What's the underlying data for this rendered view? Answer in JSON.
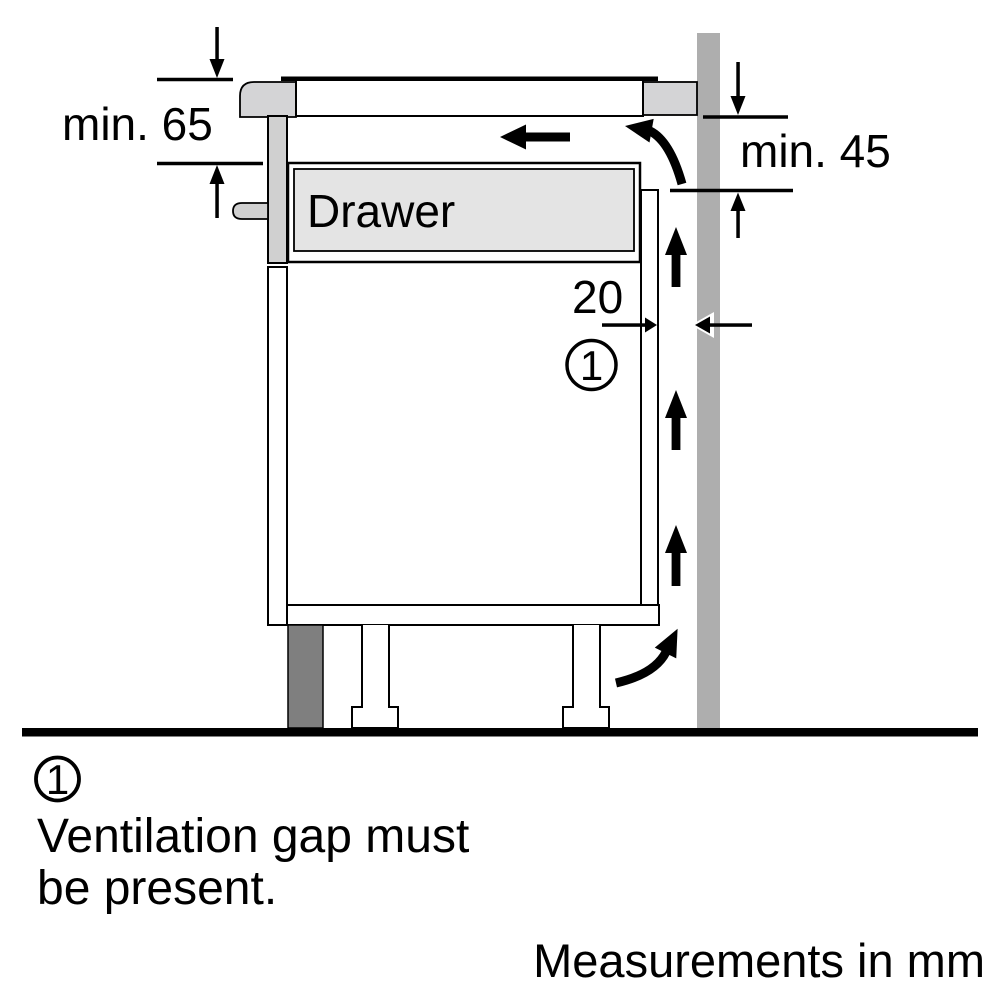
{
  "diagram": {
    "dimensions": {
      "top_left": "min. 65",
      "top_right": "min. 45",
      "ventilation_gap": "20"
    },
    "drawer_label": "Drawer",
    "callout_marker": "1",
    "colors": {
      "wall": "#aeaeae",
      "plinth": "#7f7f7f",
      "drawer": "#e4e4e4",
      "hob_trim": "#d4d4d6",
      "panel": "#d0d0d0",
      "outline": "#000000",
      "background": "#ffffff"
    }
  },
  "legend": {
    "marker": "1",
    "text_line1": "Ventilation gap must",
    "text_line2": "be present."
  },
  "footer": {
    "note": "Measurements in mm"
  }
}
